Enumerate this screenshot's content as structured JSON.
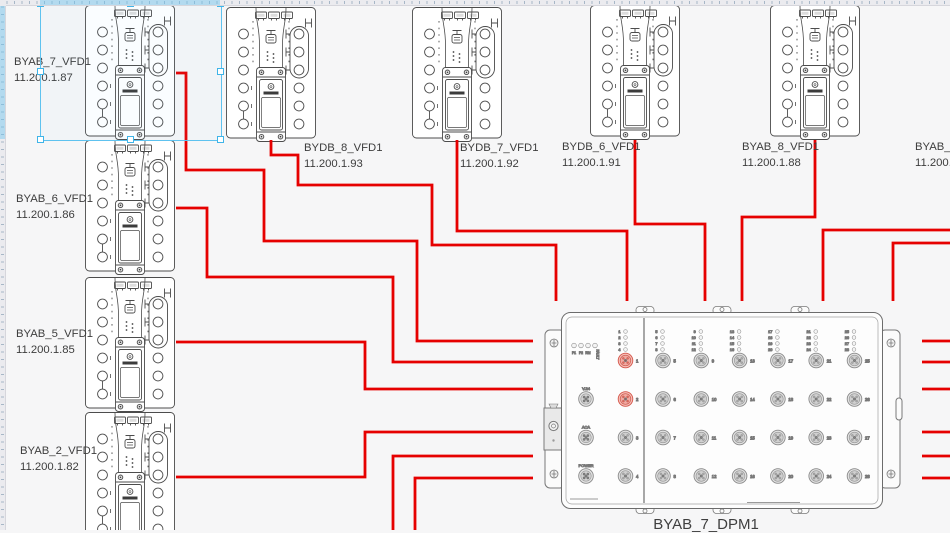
{
  "app": {
    "canvas_bg": "#f6f6f7",
    "cable_color": "#e60000",
    "selection_color": "#5ec2ef",
    "highlight_port_color": "#e2574a"
  },
  "devices": [
    {
      "id": "BYAB_7_VFD1",
      "ip": "11.200.1.87",
      "x": 85,
      "y": 5,
      "label_x": 14,
      "label_y": 55,
      "shape": true,
      "selected": true
    },
    {
      "id": "BYAB_6_VFD1",
      "ip": "11.200.1.86",
      "x": 85,
      "y": 140,
      "label_x": 16,
      "label_y": 192,
      "shape": true
    },
    {
      "id": "BYAB_5_VFD1",
      "ip": "11.200.1.85",
      "x": 85,
      "y": 277,
      "label_x": 16,
      "label_y": 327,
      "shape": true
    },
    {
      "id": "BYAB_2_VFD1",
      "ip": "11.200.1.82",
      "x": 85,
      "y": 412,
      "label_x": 20,
      "label_y": 444,
      "shape": true
    },
    {
      "id": "BYDB_8_VFD1",
      "ip": "11.200.1.93",
      "x": 226,
      "y": 7,
      "label_x": 304,
      "label_y": 141,
      "shape": true
    },
    {
      "id": "BYDB_7_VFD1",
      "ip": "11.200.1.92",
      "x": 412,
      "y": 7,
      "label_x": 460,
      "label_y": 141,
      "shape": true
    },
    {
      "id": "BYDB_6_VFD1",
      "ip": "11.200.1.91",
      "x": 590,
      "y": 5,
      "label_x": 562,
      "label_y": 140,
      "shape": true
    },
    {
      "id": "BYAB_8_VFD1",
      "ip": "11.200.1.88",
      "x": 770,
      "y": 5,
      "label_x": 742,
      "label_y": 140,
      "shape": true
    },
    {
      "id": "BYAB_9_",
      "ip": "11.200.1",
      "x": 958,
      "y": 5,
      "label_x": 915,
      "label_y": 140,
      "shape": false
    }
  ],
  "cables": [
    {
      "id": "BYAB_7_VFD1",
      "path": "M176,73 H186 V170 H264 V241 H417 V341 H533"
    },
    {
      "id": "BYAB_6_VFD1",
      "path": "M176,208 H207 V277 H393 V362 H533"
    },
    {
      "id": "BYAB_5_VFD1",
      "path": "M176,342 H365 V389 H533"
    },
    {
      "id": "BYAB_2_VFD1",
      "path": "M176,477 H365 V432 H533"
    },
    {
      "id": "offscreen-bottom-1",
      "path": "M393,531 V456 H533"
    },
    {
      "id": "offscreen-bottom-2",
      "path": "M415,531 V478 H533"
    },
    {
      "id": "BYDB_8_VFD1",
      "path": "M271,140 V155 H298 V185 H432 V245 H556 V301"
    },
    {
      "id": "BYDB_7_VFD1",
      "path": "M457,140 V231 H627 V301"
    },
    {
      "id": "BYDB_6_VFD1",
      "path": "M635,140 V224 H705 V301"
    },
    {
      "id": "BYAB_8_VFD1",
      "path": "M815,140 V217 H742 V301"
    },
    {
      "id": "offscreen-right-1",
      "path": "M951,230 H823 V301"
    },
    {
      "id": "offscreen-right-2",
      "path": "M951,243 H893 V301"
    },
    {
      "id": "panel-right-stub-1",
      "path": "M922,341 H951"
    },
    {
      "id": "panel-right-stub-2",
      "path": "M922,362 H951"
    },
    {
      "id": "panel-right-stub-3",
      "path": "M922,389 H951"
    },
    {
      "id": "panel-right-stub-4",
      "path": "M922,432 H951"
    },
    {
      "id": "panel-right-stub-5",
      "path": "M922,456 H951"
    },
    {
      "id": "panel-right-stub-6",
      "path": "M922,478 H951"
    }
  ],
  "panel": {
    "id": "BYAB_7_DPM1",
    "label_x": 706,
    "label_y": 516,
    "status_leds": [
      "P1",
      "P2",
      "RM",
      "FAULT"
    ],
    "aux_ports": [
      "V.24",
      "ACA",
      "POWER"
    ],
    "left_ports": [
      {
        "n": "1",
        "hl": true
      },
      {
        "n": "2",
        "hl": true
      },
      {
        "n": "3",
        "hl": false
      },
      {
        "n": "4",
        "hl": false
      }
    ],
    "columns": [
      [
        "5",
        "6",
        "7",
        "8"
      ],
      [
        "9",
        "10",
        "11",
        "12"
      ],
      [
        "13",
        "14",
        "15",
        "16"
      ],
      [
        "17",
        "18",
        "19",
        "20"
      ],
      [
        "21",
        "22",
        "23",
        "24"
      ],
      [
        "25",
        "26",
        "27",
        "28"
      ]
    ],
    "left_led_numbers": [
      "1",
      "2",
      "3",
      "4"
    ]
  },
  "selection": {
    "x": 40,
    "y": 3,
    "w": 180,
    "h": 136
  }
}
